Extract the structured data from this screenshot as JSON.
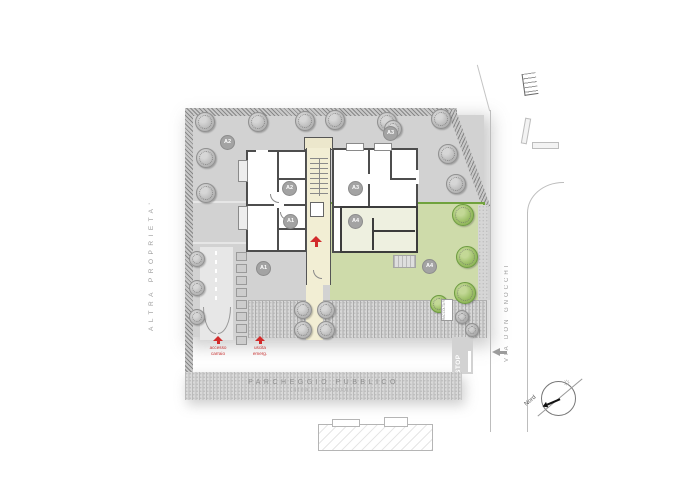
{
  "site": {
    "adjacent_property_label": "ALTRA PROPRIETA'",
    "street_label": "VIA DON GNOCCHI",
    "public_parking_title": "PARCHEGGIO PUBBLICO",
    "public_parking_subtitle": "(area in cessione)",
    "vehicle_access_label": "accesso carraio",
    "emergency_exit_label": "uscita emerg.",
    "waste_collection_label": "RACCOLTA RIFIUTI",
    "stop_label": "STOP",
    "north_label": "Nord"
  },
  "units": {
    "a1": "A1",
    "a2": "A2",
    "a3": "A3",
    "a4": "A4"
  },
  "icons": {
    "sun": "☼"
  },
  "colors": {
    "site_gray": "#d2d2d2",
    "garden_green": "#cedbaa",
    "garden_border": "#70a23d",
    "stair_core_beige": "#f2eed4",
    "accent_red": "#c73030"
  }
}
